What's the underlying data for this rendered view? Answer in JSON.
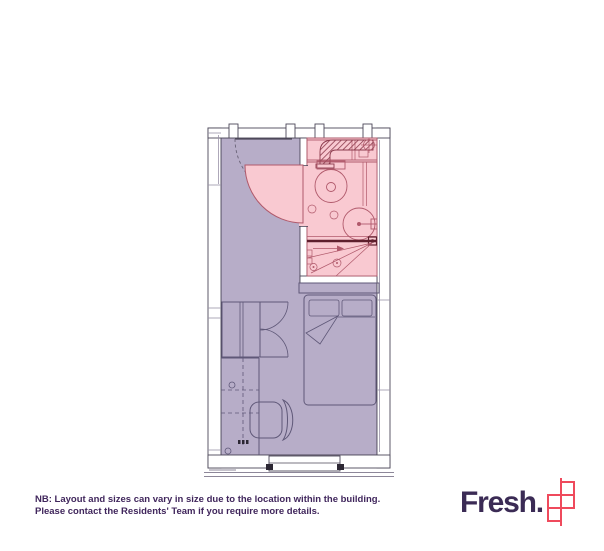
{
  "note": {
    "line1": "NB: Layout and sizes can vary in size due to the location within the building.",
    "line2": "Please contact the Residents' Team if you require more details."
  },
  "brand": {
    "wordmark": "Fresh."
  },
  "colors": {
    "room_fill": "#b7adc8",
    "bath_fill": "#f9c9d1",
    "bath_line": "#b0596b",
    "wall_line": "#4d4759",
    "furn_line": "#5f5878",
    "screen_line": "#5e1f2d",
    "text_color": "#40265c",
    "logo_text": "#3b2b55",
    "logo_mark": "#ef4a5c"
  },
  "plan": {
    "elements": [
      "entrance-door",
      "bathroom-pod",
      "bathroom-door",
      "extract-duct",
      "extract-fan",
      "toilet",
      "washbasin",
      "shower-screen",
      "shower-head",
      "drain",
      "bed",
      "pillows",
      "wardrobe",
      "desk",
      "overhead-shelf",
      "desk-chair",
      "window",
      "sockets"
    ]
  }
}
